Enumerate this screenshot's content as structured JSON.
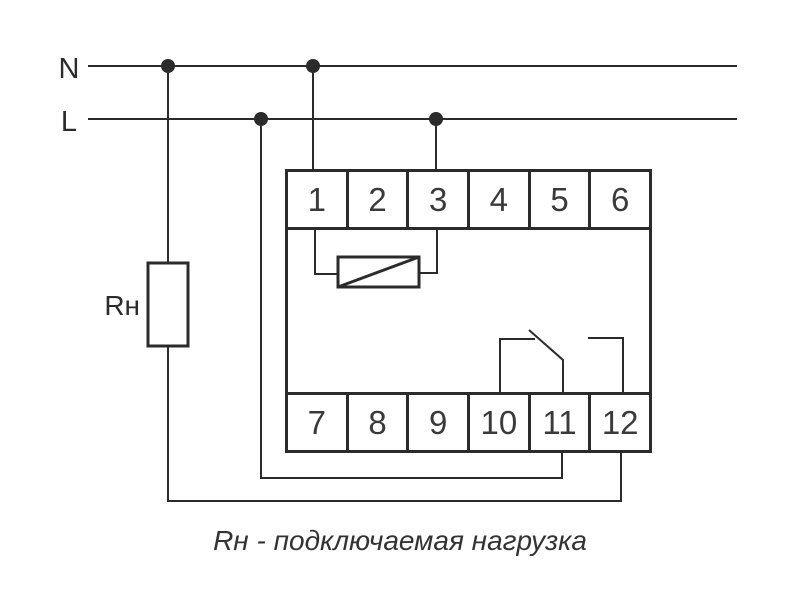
{
  "labels": {
    "neutral": "N",
    "phase": "L",
    "load": "Rн"
  },
  "device": {
    "top_terminals": [
      "1",
      "2",
      "3",
      "4",
      "5",
      "6"
    ],
    "bottom_terminals": [
      "7",
      "8",
      "9",
      "10",
      "11",
      "12"
    ]
  },
  "caption": "Rн - подключаемая нагрузка",
  "colors": {
    "line": "#2b2b2b",
    "text": "#3a3a3a",
    "background": "#ffffff"
  }
}
